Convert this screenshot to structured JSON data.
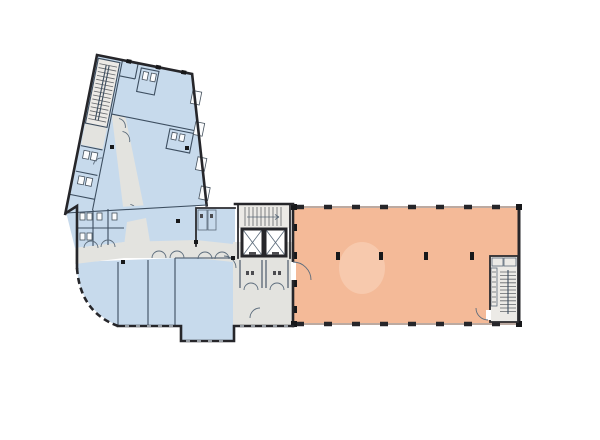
{
  "palette": {
    "background": "#ffffff",
    "wall": "#26262a",
    "partition": "#3d4e60",
    "room_blue": "#c7daec",
    "corridor_gray": "#e3e3df",
    "stair_gray": "#eceae6",
    "hall_orange": "#f4ba98",
    "hall_orange_patch": "#f7c9ad",
    "fixture_white": "#fbfcfd",
    "column_dark": "#17181a"
  },
  "drawing": {
    "type": "building-floor-plan",
    "regions": [
      {
        "id": "west-wing",
        "role": "office-rooms",
        "fill": "room_blue"
      },
      {
        "id": "south-block",
        "role": "office-rooms",
        "fill": "room_blue"
      },
      {
        "id": "corridors",
        "role": "circulation",
        "fill": "corridor_gray"
      },
      {
        "id": "elevator-core",
        "role": "vertical-circulation",
        "fill": "stair_gray"
      },
      {
        "id": "entrance-hall",
        "role": "circulation",
        "fill": "corridor_gray"
      },
      {
        "id": "open-hall",
        "role": "open-plan-area",
        "fill": "hall_orange"
      }
    ],
    "features": {
      "elevators": 2,
      "stairwells": 3,
      "visible_text": ""
    }
  }
}
